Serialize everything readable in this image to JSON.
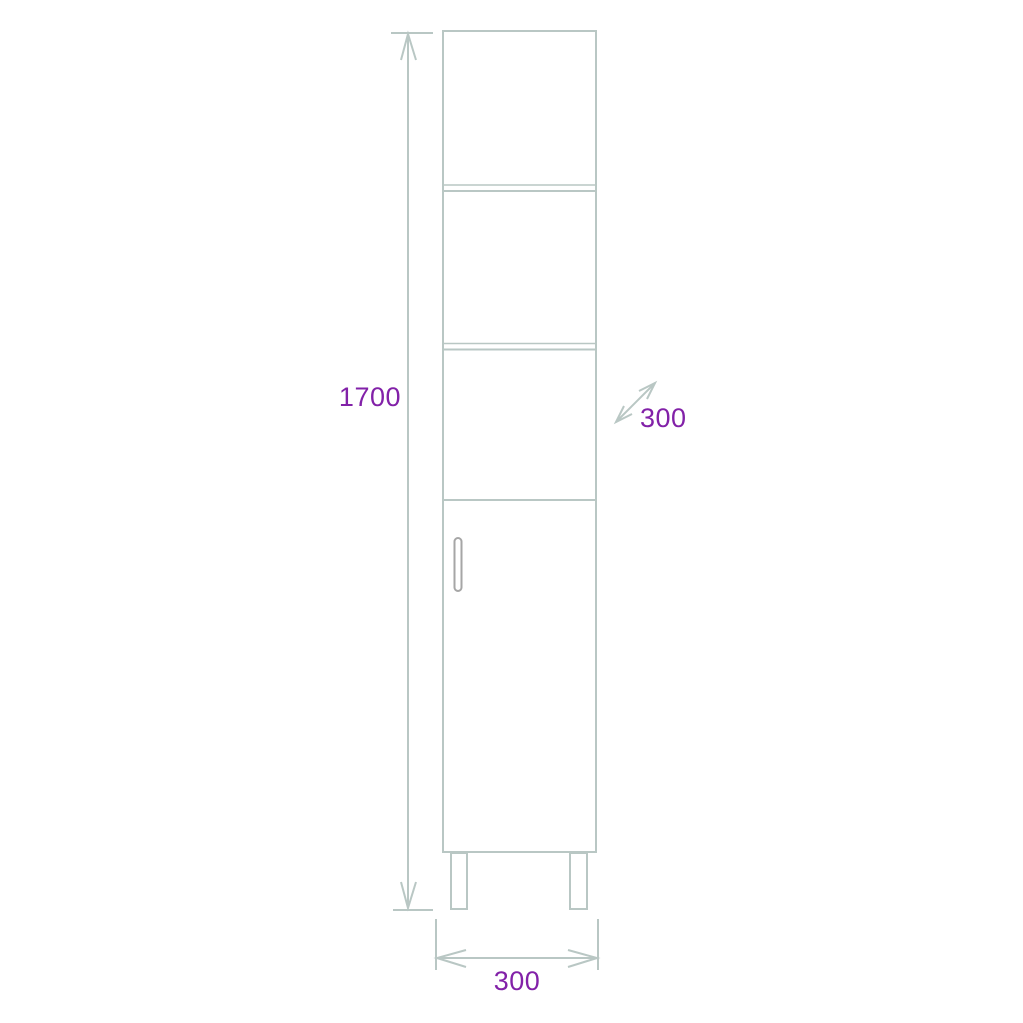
{
  "colors": {
    "line": "#b9c7c4",
    "handle": "#a6a6a6",
    "label": "#8221a8",
    "background": "#ffffff"
  },
  "drawing": {
    "subject": "tall narrow cabinet elevation with three open compartments, lower door with handle, and two legs",
    "dimensions": {
      "height": {
        "label": "1700"
      },
      "depth": {
        "label": "300"
      },
      "width": {
        "label": "300"
      }
    }
  }
}
